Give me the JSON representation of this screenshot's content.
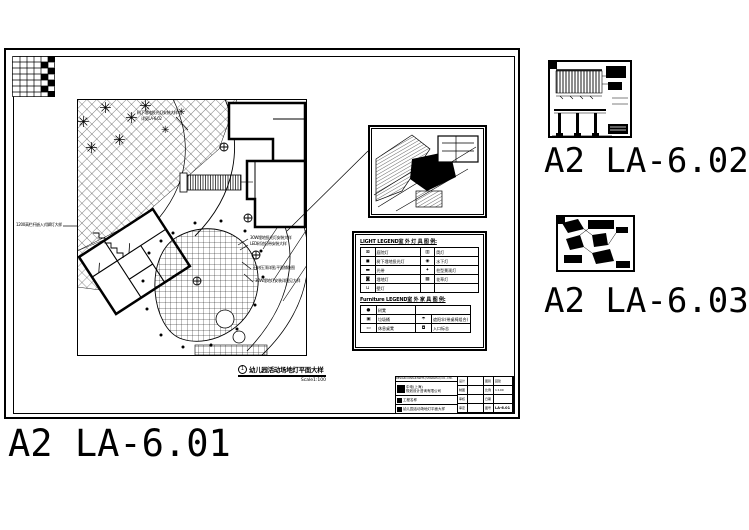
{
  "labels": {
    "main_sheet": "A2  LA-6.01",
    "sheet_02": "A2  LA-6.02",
    "sheet_03": "A2  LA-6.03"
  },
  "plan": {
    "caption_number": "1",
    "caption_title": "幼儿园活动场地灯平面大样",
    "caption_scale": "Scale1:100",
    "annotations": {
      "a1": "树下埋地投光灯安装大样",
      "a2": "详见LA-6.02",
      "a3": "1200高栏杆嵌入式脚灯大样",
      "a4": "30W埋地投光灯安装大样",
      "a5": "LED树池灯带安装大样",
      "a6": "石材压顶详图,平面铺装图",
      "a7": "30W埋地灯安装详图见大样"
    }
  },
  "light_legend": {
    "title": "LIGHT LEGEND室 外 灯 具 图 例:",
    "rows": [
      {
        "s1": "⊠",
        "n1": "庭院灯",
        "s2": "▥",
        "n2": "筒灯"
      },
      {
        "s1": "◼",
        "n1": "树下埋地投光灯",
        "s2": "◉",
        "n2": "水下灯"
      },
      {
        "s1": "▬",
        "n1": "光带",
        "s2": "✦",
        "n2": "柱型景观灯"
      },
      {
        "s1": "◙",
        "n1": "埋地灯",
        "s2": "▩",
        "n2": "花草灯"
      },
      {
        "s1": "⊔",
        "n1": "壁灯",
        "s2": "",
        "n2": ""
      }
    ]
  },
  "furniture_legend": {
    "title": "Furniture LEGEND室 外 家 具 图 例:",
    "rows": [
      {
        "s1": "●",
        "n1": "树凳",
        "s2": "",
        "n2": ""
      },
      {
        "s1": "▣",
        "n1": "垃圾桶",
        "s2": "☂",
        "n2": "遮阳伞(带桌椅组合)"
      },
      {
        "s1": "▭",
        "n1": "休息桌凳",
        "s2": "◘",
        "n2": "入口标志"
      }
    ]
  },
  "title_block": {
    "company_en": "DESIGN CONSULTANTS (SHANGHAI) CO., LTD.",
    "company_cn1": "中电(上海)",
    "company_cn2": "规划设计咨询有限公司",
    "project_label": "工程名称",
    "drawing_title": "幼儿园活动场地灯平面大样",
    "grid": {
      "r1c1": "设计",
      "r1c3": "图别",
      "r1c4": "园建",
      "r2c1": "制图",
      "r2c3": "比例",
      "r2c4": "1:100",
      "r3c1": "审核",
      "r3c3": "日期",
      "r3c4": "",
      "r4c1": "审定",
      "r4c3": "图号",
      "r4c4": "LA-6.01"
    }
  },
  "colors": {
    "ink": "#000000",
    "paper": "#ffffff"
  }
}
